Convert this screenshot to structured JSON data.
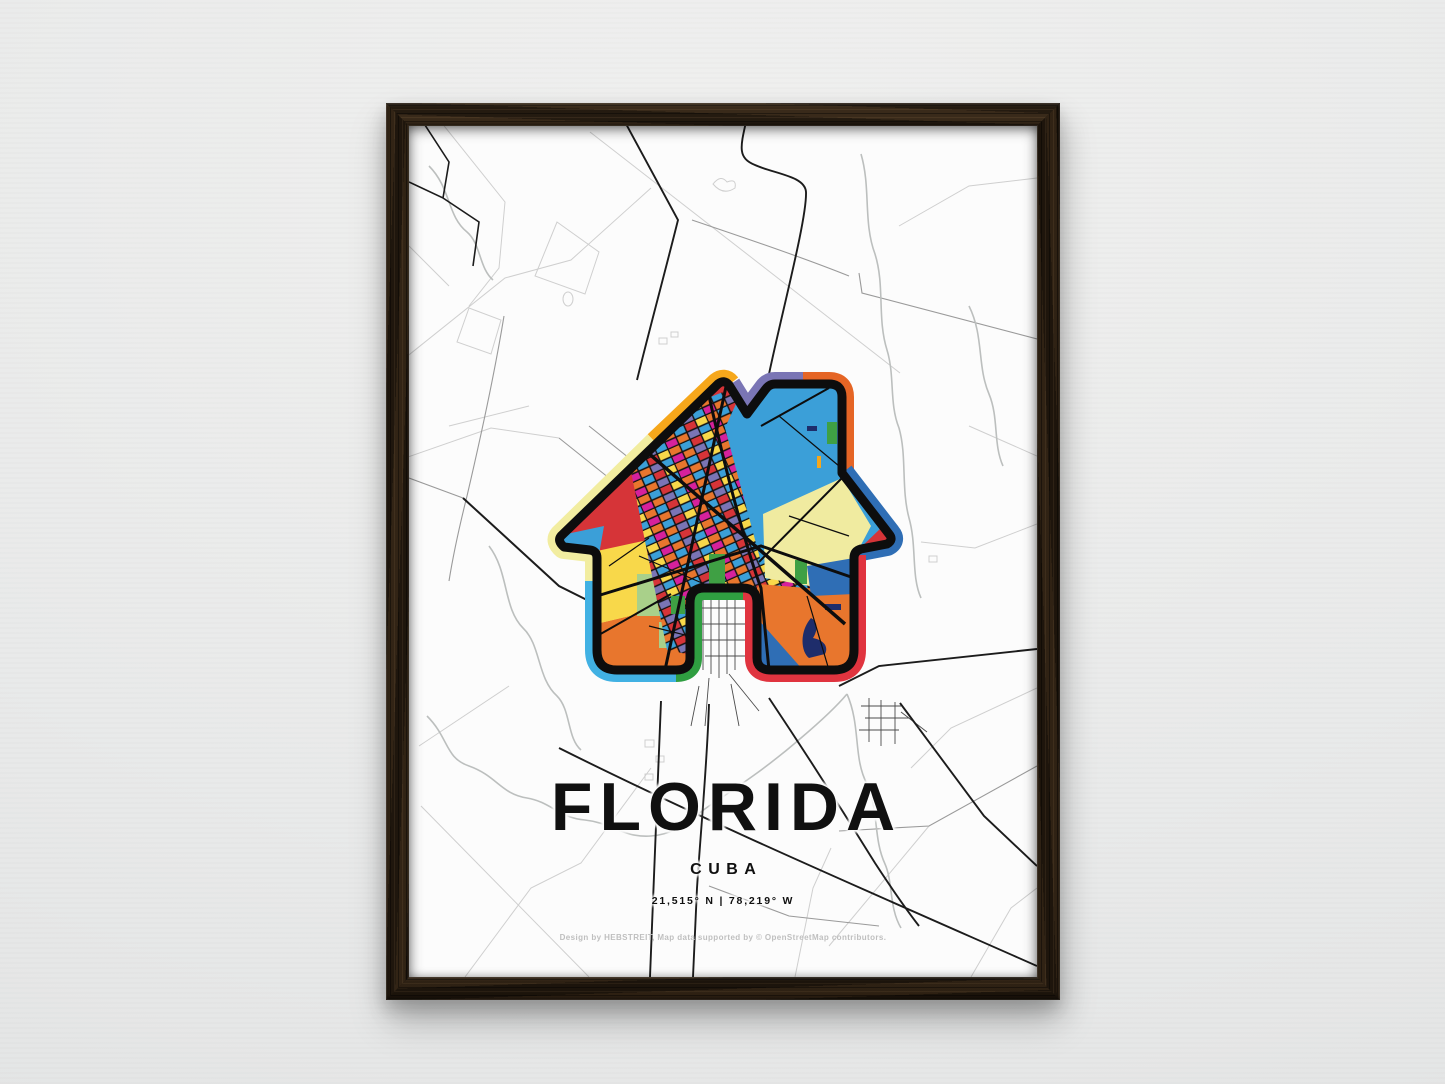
{
  "poster": {
    "title": "FLORIDA",
    "subtitle": "CUBA",
    "coordinates": "21,515° N | 78,219° W",
    "credit": "Design by HEBSTREIT, Map data supported by © OpenStreetMap contributors."
  },
  "art": {
    "shape": "house-with-chimney-map-art",
    "ring": {
      "gold": "#F6A71B",
      "pale_yellow": "#F2EDA0",
      "cyan": "#41B1E3",
      "green": "#2F9E41",
      "red": "#E0343F",
      "blue": "#2F6EB5",
      "orange": "#E56525",
      "purple": "#7A75B5"
    },
    "map": {
      "crimson": "#D63438",
      "magenta": "#D6219C",
      "light_blue": "#3B9FD8",
      "pale_yellow": "#F0EBA0",
      "orange": "#E8762D",
      "royal_blue": "#2F6EB5",
      "yellow": "#F8D84A",
      "green": "#3FA044",
      "light_green": "#A9D08A",
      "navy": "#1E2D6B",
      "outline_black": "#0D0D0D"
    }
  },
  "scene": {
    "wall_color": "#e9eaea",
    "frame_wood_color": "#261c12",
    "paper_color": "#fcfcfc",
    "road_dark": "#1c1c1c",
    "road_medium": "#9a9a9a",
    "road_light": "#cfcfcf",
    "river": "#bcbfbe",
    "town_grid": "#4c4c4c"
  }
}
